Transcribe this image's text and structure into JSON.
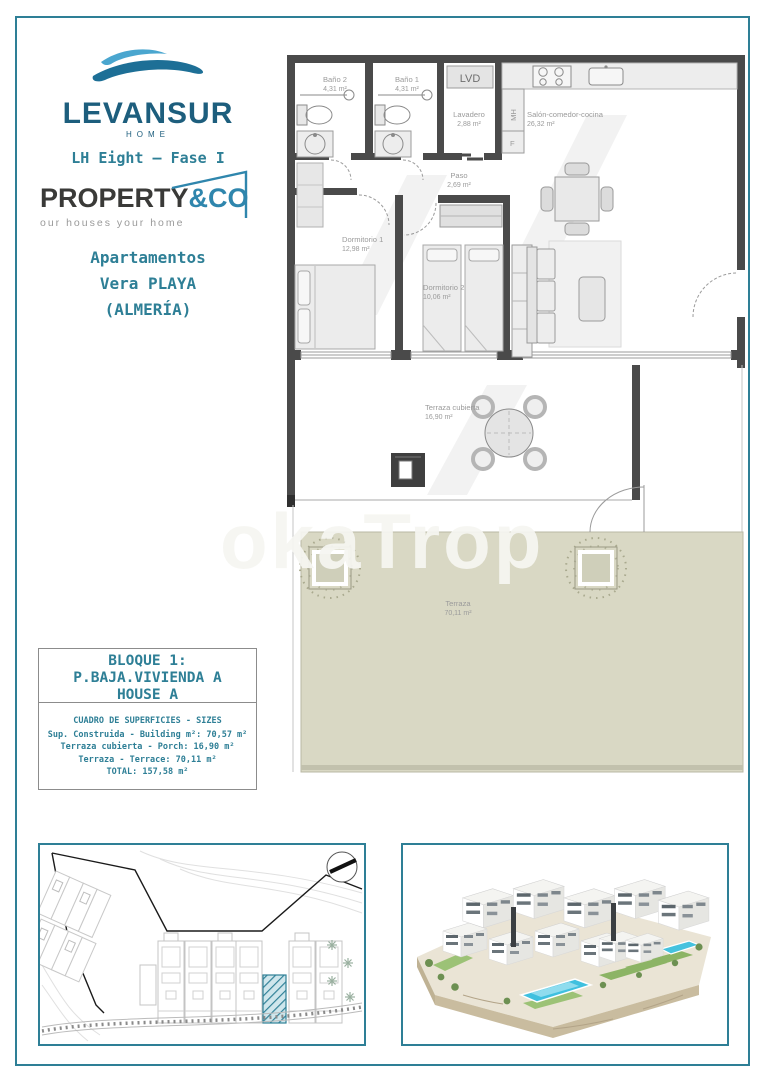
{
  "colors": {
    "accent_teal": "#2e7f96",
    "brand_dark": "#1d5e7d",
    "agency_blue": "#2f86ad",
    "terrace_green": "#d9d8c4",
    "highlight_hatch": "#2f8097"
  },
  "watermark": {
    "text": "okaTrop"
  },
  "header": {
    "brand": {
      "name": "LEVANSUR",
      "sub": "HOME",
      "project": "LH Eight – Fase I"
    },
    "agency": {
      "primary": "PROPERTY",
      "accent": "&CO",
      "tagline": "our houses your home"
    },
    "location": {
      "l1": "Apartamentos",
      "l2": "Vera PLAYA",
      "l3": "(ALMERÍA)"
    }
  },
  "plan": {
    "rooms": [
      {
        "name": "Baño 2",
        "area": "4,31 m²"
      },
      {
        "name": "Baño 1",
        "area": "4,31 m²"
      },
      {
        "name": "LVD",
        "area": ""
      },
      {
        "name": "Lavadero",
        "area": "2,88 m²"
      },
      {
        "name": "Salón-comedor-cocina",
        "area": "26,32 m²"
      },
      {
        "name": "Paso",
        "area": "2,69 m²"
      },
      {
        "name": "Dormitorio 1",
        "area": "12,98 m²"
      },
      {
        "name": "Dormitorio 2",
        "area": "10,06 m²"
      },
      {
        "name": "Terraza cubierta",
        "area": "16,90 m²"
      },
      {
        "name": "Terraza",
        "area": "70,11 m²"
      }
    ],
    "appliances": [
      "MH",
      "F"
    ]
  },
  "unit_box": {
    "lines": [
      "BLOQUE 1:",
      "P.BAJA.VIVIENDA A",
      "HOUSE A"
    ]
  },
  "sizes_box": {
    "title": "CUADRO DE SUPERFICIES  - SIZES",
    "rows": [
      "Sup. Construida  - Building m²: 70,57 m²",
      "Terraza cubierta  - Porch: 16,90 m²",
      "Terraza  - Terrace: 70,11 m²",
      "TOTAL:  157,58 m²"
    ]
  }
}
